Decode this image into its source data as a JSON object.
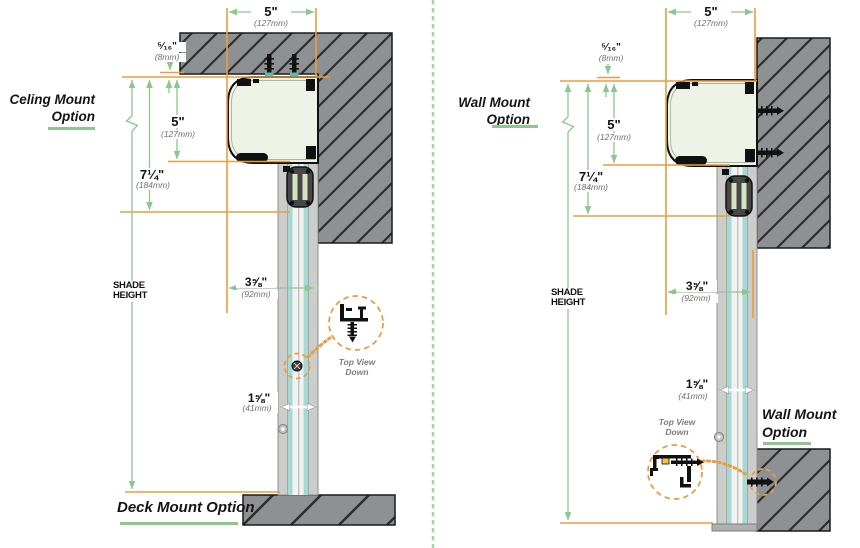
{
  "colors": {
    "accent_orange": "#ED9C3E",
    "accent_green": "#8CC88C",
    "hatch_gray": "#8E9194",
    "teal_stripe": "#A6D9D4",
    "housing_fill": "#EDF3E7"
  },
  "left": {
    "title_line1": "Celing Mount",
    "title_line2": "Option",
    "footer_label": "Deck Mount Option",
    "shade_height_label": "SHADE HEIGHT",
    "detail_label_line1": "Top View",
    "detail_label_line2": "Down",
    "dims": {
      "top_width": {
        "in": "5\"",
        "mm": "(127mm)"
      },
      "top_gap": {
        "in": "⁵⁄₁₆\"",
        "mm": "(8mm)"
      },
      "housing_height": {
        "in": "5\"",
        "mm": "(127mm)"
      },
      "header_drop": {
        "in": "7¼\"",
        "mm": "(184mm)"
      },
      "housing_depth": {
        "in": "3⅝\"",
        "mm": "(92mm)"
      },
      "track_width": {
        "in": "1⅝\"",
        "mm": "(41mm)"
      }
    }
  },
  "right": {
    "title_line1": "Wall Mount",
    "title_line2": "Option",
    "footer_label_line1": "Wall Mount",
    "footer_label_line2": "Option",
    "shade_height_label": "SHADE HEIGHT",
    "detail_label_line1": "Top View",
    "detail_label_line2": "Down",
    "dims": {
      "top_width": {
        "in": "5\"",
        "mm": "(127mm)"
      },
      "top_gap": {
        "in": "⁵⁄₁₆\"",
        "mm": "(8mm)"
      },
      "housing_height": {
        "in": "5\"",
        "mm": "(127mm)"
      },
      "header_drop": {
        "in": "7¼\"",
        "mm": "(184mm)"
      },
      "housing_depth": {
        "in": "3⅝\"",
        "mm": "(92mm)"
      },
      "track_width": {
        "in": "1⅝\"",
        "mm": "(41mm)"
      }
    }
  }
}
